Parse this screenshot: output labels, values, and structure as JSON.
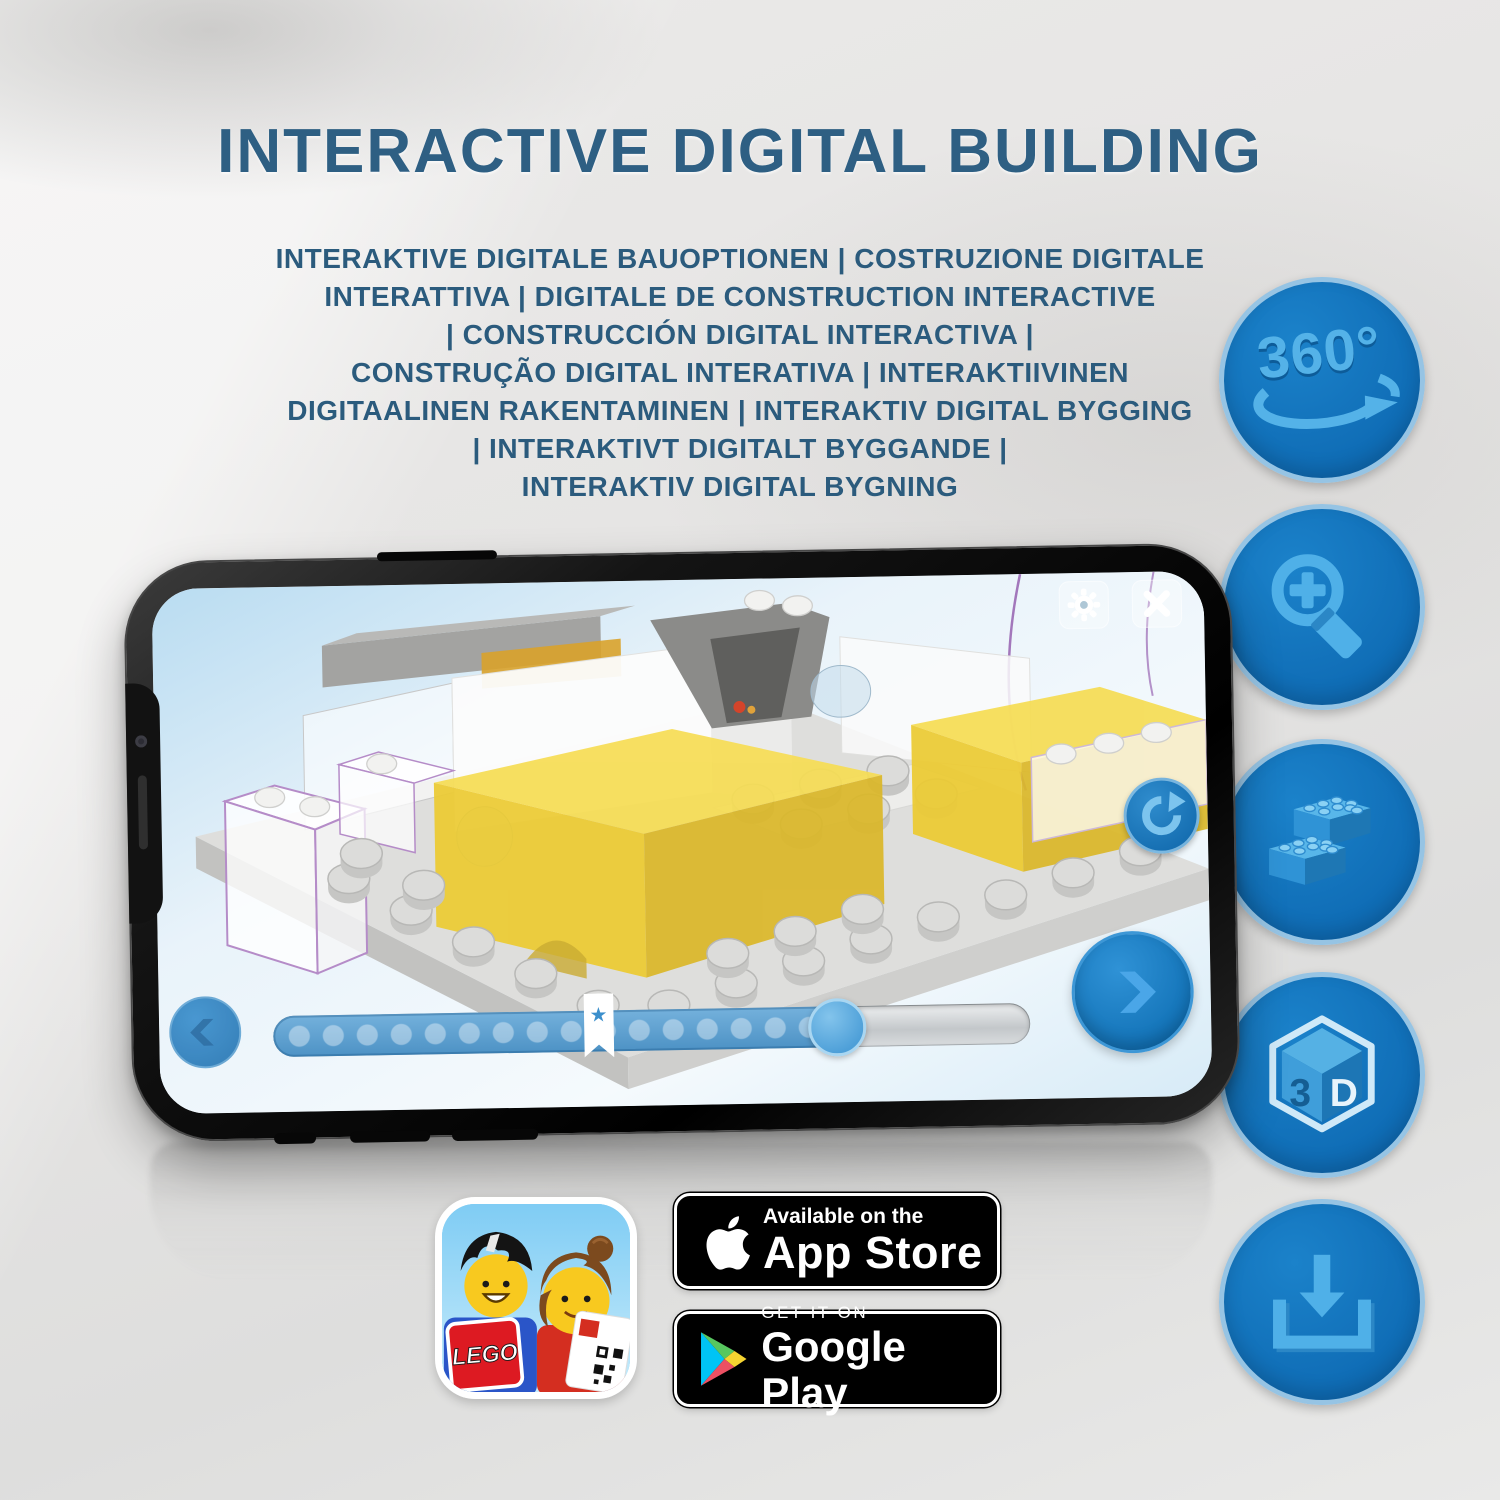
{
  "page": {
    "title": "INTERACTIVE DIGITAL BUILDING"
  },
  "subtitle": {
    "lines": [
      "INTERAKTIVE DIGITALE BAUOPTIONEN | COSTRUZIONE DIGITALE",
      "INTERATTIVA | DIGITALE DE CONSTRUCTION INTERACTIVE",
      "| CONSTRUCCIÓN DIGITAL INTERACTIVA |",
      "CONSTRUÇÃO DIGITAL INTERATIVA | INTERAKTIIVINEN",
      "DIGITAALINEN RAKENTAMINEN | INTERAKTIV DIGITAL BYGGING",
      "| INTERAKTIVT DIGITALT BYGGANDE |",
      "INTERAKTIV DIGITAL BYGNING"
    ]
  },
  "features": {
    "rotation_label": "360°",
    "cube_left": "3",
    "cube_right": "D",
    "items": [
      {
        "name": "360-rotation"
      },
      {
        "name": "zoom-in"
      },
      {
        "name": "bricks"
      },
      {
        "name": "3d-view"
      },
      {
        "name": "download"
      }
    ]
  },
  "phone": {
    "progress": {
      "completed_fraction": 0.745,
      "bookmark_fraction": 0.43,
      "bookmark_star": "★"
    }
  },
  "badges": {
    "app_store": {
      "line1": "Available on the",
      "line2": "App Store"
    },
    "google_play": {
      "line1": "GET IT ON",
      "line2": "Google Play"
    },
    "lego_logo": "LEGO"
  },
  "colors": {
    "title_blue": "#2e5f83",
    "circle_blue": "#1276be",
    "glyph_blue": "#4fb0e8",
    "lego_yellow": "#f2d23e",
    "badge_black": "#000000"
  }
}
